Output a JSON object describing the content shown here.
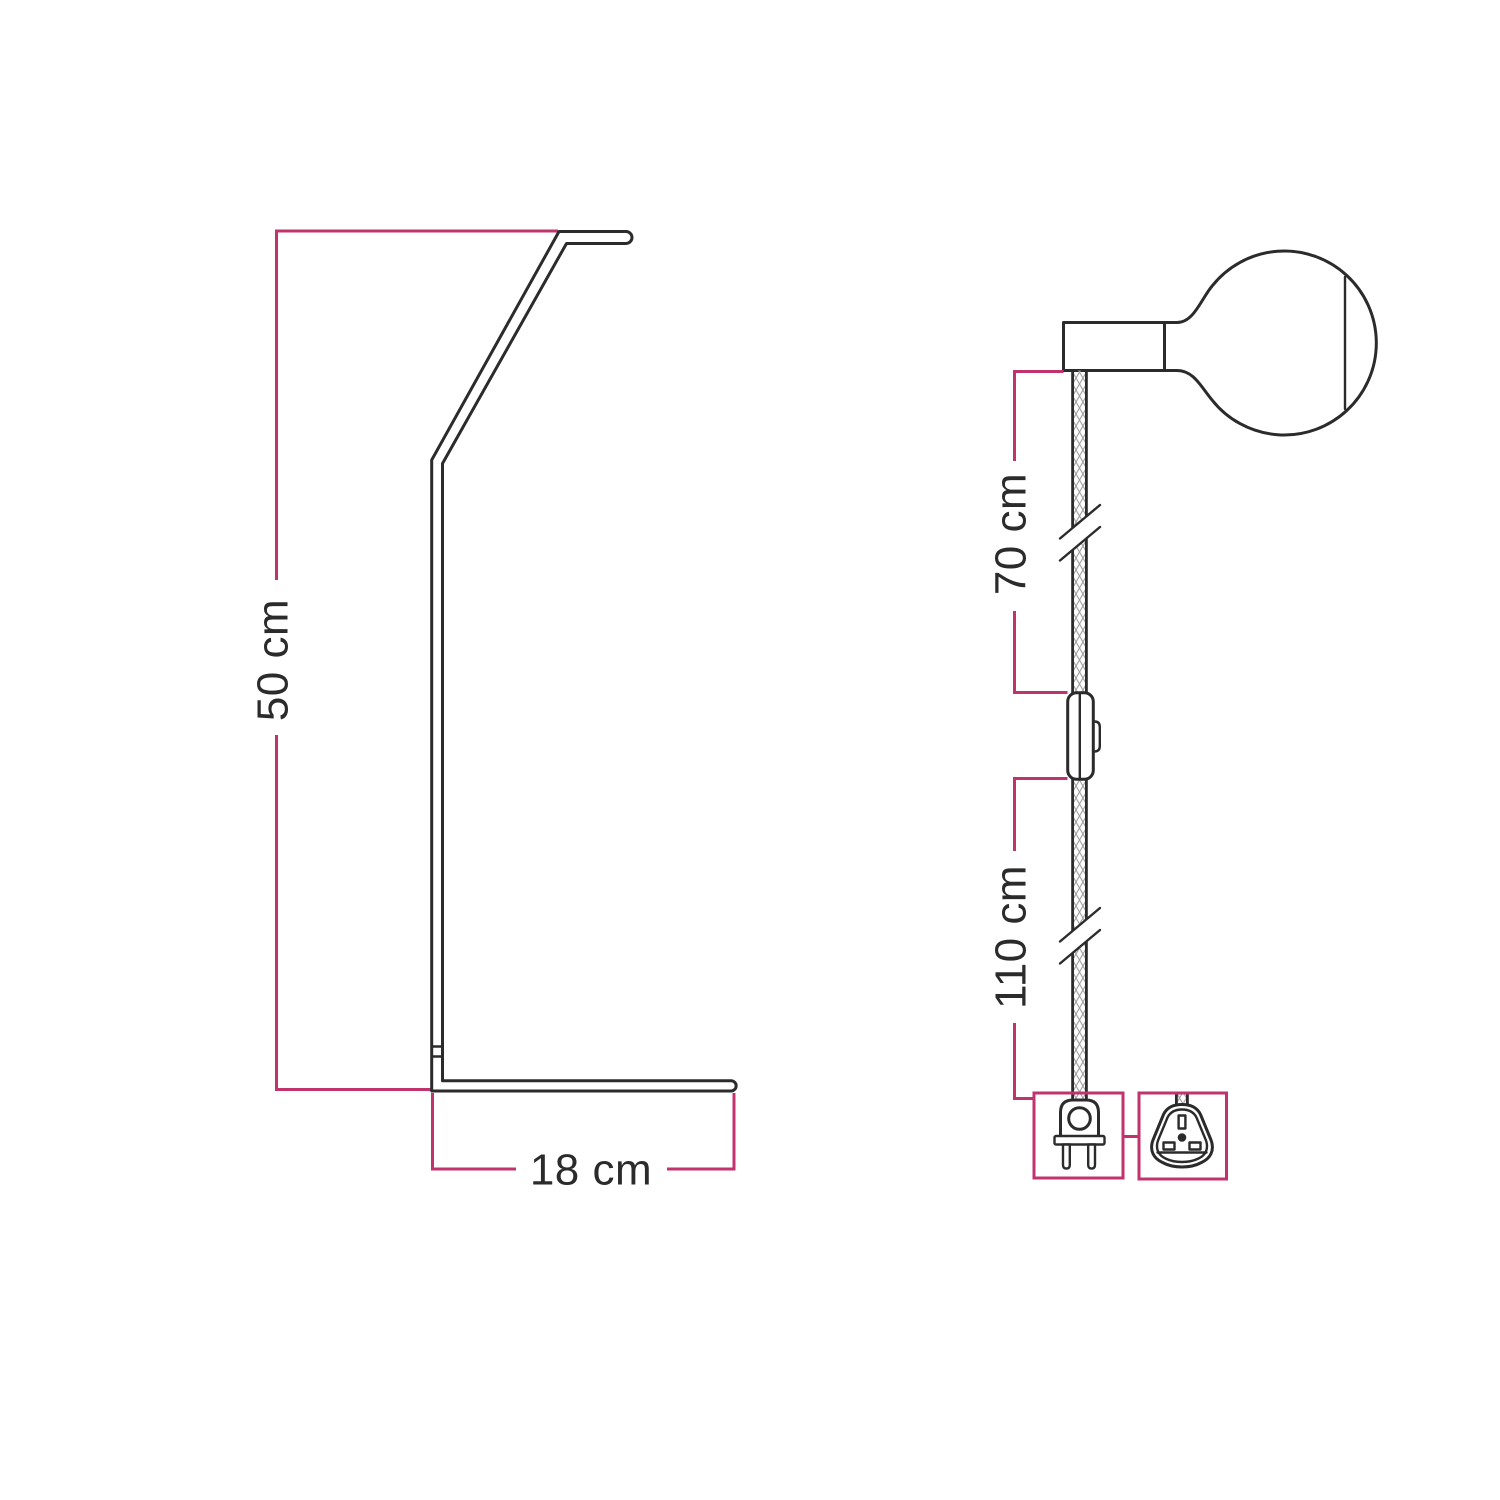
{
  "diagram": {
    "kind": "lamp-dimensions-technical-drawing",
    "labels": {
      "stand_height": "50 cm",
      "stand_depth": "18 cm",
      "cable_upper": "70 cm",
      "cable_lower": "110 cm"
    },
    "icons": {
      "stand-profile-icon": "angled lamp stand side outline",
      "lamp-socket-icon": "horizontal socket rectangle",
      "globe-bulb-icon": "globe light bulb outline",
      "textile-cable-icon": "braided cable crosshatch strip",
      "cable-break-icon": "double slash length-break mark",
      "inline-switch-icon": "rocker switch on cable",
      "euro-plug-icon": "two-pin europlug outline",
      "uk-plug-icon": "UK three-slot plug outline"
    },
    "colors": {
      "dimension": "#c0336c",
      "drawing": "#2b2b2b",
      "hatch": "#9e9e9e",
      "background": "#ffffff"
    }
  }
}
